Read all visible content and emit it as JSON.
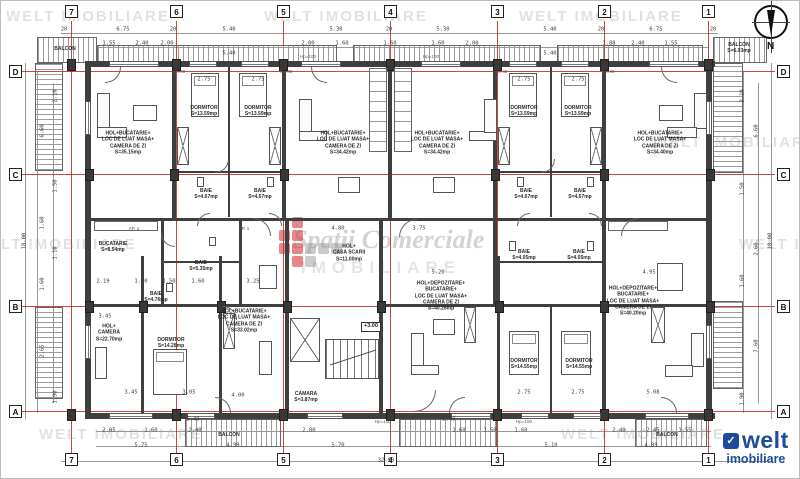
{
  "watermark": {
    "text": "WELT IMOBILIARE",
    "positions": [
      [
        5,
        8
      ],
      [
        263,
        8
      ],
      [
        518,
        8
      ],
      [
        652,
        134
      ],
      [
        -28,
        236
      ],
      [
        738,
        236
      ],
      [
        38,
        426
      ],
      [
        560,
        426
      ]
    ],
    "center_title": "Spații Comerciale",
    "center_sub": "IMOBILIARE"
  },
  "brand": {
    "name": "welt",
    "sub": "imobiliare",
    "icon": "✓"
  },
  "compass": {
    "label": "N"
  },
  "level_marker": "+3.00",
  "grid": {
    "cols": [
      {
        "label": "7",
        "x": 70
      },
      {
        "label": "6",
        "x": 175
      },
      {
        "label": "5",
        "x": 282
      },
      {
        "label": "4",
        "x": 389
      },
      {
        "label": "3",
        "x": 496
      },
      {
        "label": "2",
        "x": 603
      },
      {
        "label": "1",
        "x": 707
      }
    ],
    "rows": [
      {
        "label": "D",
        "y": 70
      },
      {
        "label": "C",
        "y": 173
      },
      {
        "label": "B",
        "y": 305
      },
      {
        "label": "A",
        "y": 410
      }
    ]
  },
  "rooms": [
    {
      "label": "HOL+BUCATARIE+\nLOC DE LUAT MASA+\nCAMERA DE ZI\nS=35.15mp",
      "x": 127,
      "y": 142
    },
    {
      "label": "DORMITOR\nS=13.59mp",
      "x": 203,
      "y": 110
    },
    {
      "label": "DORMITOR\nS=13.59mp",
      "x": 257,
      "y": 110
    },
    {
      "label": "BAIE\nS=4.67mp",
      "x": 205,
      "y": 193
    },
    {
      "label": "BAIE\nS=4.67mp",
      "x": 259,
      "y": 193
    },
    {
      "label": "HOL+BUCATARIE+\nLOC DE LUAT MASA+\nCAMERA DE ZI\nS=34.42mp",
      "x": 342,
      "y": 142
    },
    {
      "label": "HOL+BUCATARIE+\nLOC DE LUAT MASA+\nCAMERA DE ZI\nS=34.42mp",
      "x": 436,
      "y": 142
    },
    {
      "label": "DORMITOR\nS=13.59mp",
      "x": 523,
      "y": 110
    },
    {
      "label": "DORMITOR\nS=13.59mp",
      "x": 577,
      "y": 110
    },
    {
      "label": "BAIE\nS=4.67mp",
      "x": 525,
      "y": 193
    },
    {
      "label": "BAIE\nS=4.67mp",
      "x": 579,
      "y": 193
    },
    {
      "label": "HOL+BUCATARIE+\nLOC DE LUAT MASA+\nCAMERA DE ZI\nS=34.40mp",
      "x": 659,
      "y": 142
    },
    {
      "label": "BUCATARIE\nS=8.54mp",
      "x": 112,
      "y": 246
    },
    {
      "label": "BAIE\nS=5.35mp",
      "x": 200,
      "y": 265
    },
    {
      "label": "BAIE\nS=4.76mp",
      "x": 155,
      "y": 296
    },
    {
      "label": "HOL+\nCASA SCARII\nS=11.00mp",
      "x": 348,
      "y": 252
    },
    {
      "label": "HOL+BUCATARIE+\nLOC DE LUAT MASA+\nCAMERA DE ZI\nS=33.02mp",
      "x": 243,
      "y": 320
    },
    {
      "label": "HOL+\nCAMERA\nS=22.70mp",
      "x": 108,
      "y": 332
    },
    {
      "label": "DORMITOR\nS=14.28mp",
      "x": 170,
      "y": 342
    },
    {
      "label": "CAMARA\nS=3.87mp",
      "x": 305,
      "y": 396
    },
    {
      "label": "HOL+DEPOZITARE+\nBUCATARIE+\nLOC DE LUAT MASA+\nCAMERA DE ZI\nS=40.26mp",
      "x": 440,
      "y": 295
    },
    {
      "label": "DORMITOR\nS=14.55mp",
      "x": 523,
      "y": 363
    },
    {
      "label": "DORMITOR\nS=14.55mp",
      "x": 578,
      "y": 363
    },
    {
      "label": "BAIE\nS=4.05mp",
      "x": 523,
      "y": 254
    },
    {
      "label": "BAIE\nS=4.05mp",
      "x": 578,
      "y": 254
    },
    {
      "label": "HOL+DEPOZITARE+\nBUCATARIE+\nLOC DE LUAT MASA+\nCAMERA DE ZI\nS=40.20mp",
      "x": 632,
      "y": 300
    },
    {
      "label": "BALCON",
      "x": 64,
      "y": 48
    },
    {
      "label": "BALCON\nS=6.03mp",
      "x": 738,
      "y": 47
    },
    {
      "label": "BALCON",
      "x": 228,
      "y": 434
    },
    {
      "label": "BALCON",
      "x": 666,
      "y": 434
    }
  ],
  "dims": [
    {
      "t": "20",
      "x": 63,
      "y": 29
    },
    {
      "t": "6.75",
      "x": 122,
      "y": 29
    },
    {
      "t": "20",
      "x": 172,
      "y": 29
    },
    {
      "t": "5.40",
      "x": 228,
      "y": 29
    },
    {
      "t": "5.30",
      "x": 335,
      "y": 29
    },
    {
      "t": "20",
      "x": 388,
      "y": 29
    },
    {
      "t": "5.30",
      "x": 442,
      "y": 29
    },
    {
      "t": "5.40",
      "x": 549,
      "y": 29
    },
    {
      "t": "20",
      "x": 600,
      "y": 29
    },
    {
      "t": "6.75",
      "x": 655,
      "y": 29
    },
    {
      "t": "20",
      "x": 712,
      "y": 29
    },
    {
      "t": "1.55",
      "x": 108,
      "y": 43
    },
    {
      "t": "2.40",
      "x": 141,
      "y": 43
    },
    {
      "t": "2.00",
      "x": 166,
      "y": 43
    },
    {
      "t": "2.00",
      "x": 307,
      "y": 43
    },
    {
      "t": "1.60",
      "x": 341,
      "y": 43
    },
    {
      "t": "1.60",
      "x": 389,
      "y": 43
    },
    {
      "t": "1.60",
      "x": 437,
      "y": 43
    },
    {
      "t": "2.00",
      "x": 471,
      "y": 43
    },
    {
      "t": "1.88",
      "x": 608,
      "y": 43
    },
    {
      "t": "2.40",
      "x": 637,
      "y": 43
    },
    {
      "t": "1.55",
      "x": 670,
      "y": 43
    },
    {
      "t": "5.40",
      "x": 228,
      "y": 53
    },
    {
      "t": "5.40",
      "x": 549,
      "y": 53
    },
    {
      "t": "2.75",
      "x": 203,
      "y": 79
    },
    {
      "t": "2.75",
      "x": 257,
      "y": 79
    },
    {
      "t": "2.75",
      "x": 523,
      "y": 79
    },
    {
      "t": "2.75",
      "x": 577,
      "y": 79
    },
    {
      "t": "4.80",
      "x": 337,
      "y": 228
    },
    {
      "t": "3.75",
      "x": 418,
      "y": 228
    },
    {
      "t": "2.19",
      "x": 102,
      "y": 281
    },
    {
      "t": "1.10",
      "x": 140,
      "y": 281
    },
    {
      "t": "1.50",
      "x": 168,
      "y": 281
    },
    {
      "t": "1.60",
      "x": 197,
      "y": 281
    },
    {
      "t": "3.25",
      "x": 252,
      "y": 281
    },
    {
      "t": "5.20",
      "x": 437,
      "y": 272
    },
    {
      "t": "4.95",
      "x": 648,
      "y": 272
    },
    {
      "t": "3.45",
      "x": 104,
      "y": 316
    },
    {
      "t": "3.45",
      "x": 130,
      "y": 392
    },
    {
      "t": "3.05",
      "x": 188,
      "y": 392
    },
    {
      "t": "4.00",
      "x": 237,
      "y": 395
    },
    {
      "t": "2.75",
      "x": 523,
      "y": 392
    },
    {
      "t": "2.75",
      "x": 577,
      "y": 392
    },
    {
      "t": "5.08",
      "x": 652,
      "y": 392
    },
    {
      "t": "5.40",
      "x": 192,
      "y": 419
    },
    {
      "t": "5.40",
      "x": 448,
      "y": 419
    },
    {
      "t": "2.05",
      "x": 108,
      "y": 430
    },
    {
      "t": "1.60",
      "x": 150,
      "y": 430
    },
    {
      "t": "2.40",
      "x": 194,
      "y": 430
    },
    {
      "t": "2.80",
      "x": 308,
      "y": 430
    },
    {
      "t": "1.60",
      "x": 458,
      "y": 430
    },
    {
      "t": "1.50",
      "x": 489,
      "y": 430
    },
    {
      "t": "1.60",
      "x": 520,
      "y": 430
    },
    {
      "t": "2.40",
      "x": 618,
      "y": 430
    },
    {
      "t": "2.45",
      "x": 652,
      "y": 430
    },
    {
      "t": "1.55",
      "x": 684,
      "y": 430
    },
    {
      "t": "5.75",
      "x": 140,
      "y": 445
    },
    {
      "t": "4.99",
      "x": 232,
      "y": 445
    },
    {
      "t": "5.70",
      "x": 337,
      "y": 445
    },
    {
      "t": "5.10",
      "x": 550,
      "y": 445
    },
    {
      "t": "4.99",
      "x": 650,
      "y": 445
    },
    {
      "t": "32.90",
      "x": 385,
      "y": 460
    },
    {
      "t": "2.10",
      "x": 55,
      "y": 95,
      "r": 1
    },
    {
      "t": "6.60",
      "x": 42,
      "y": 130,
      "r": 1
    },
    {
      "t": "1.50",
      "x": 55,
      "y": 185,
      "r": 1
    },
    {
      "t": "1.60",
      "x": 42,
      "y": 222,
      "r": 1
    },
    {
      "t": "1.10",
      "x": 55,
      "y": 252,
      "r": 1
    },
    {
      "t": "1.60",
      "x": 42,
      "y": 283,
      "r": 1
    },
    {
      "t": "2.65",
      "x": 42,
      "y": 350,
      "r": 1
    },
    {
      "t": "1.90",
      "x": 55,
      "y": 396,
      "r": 1
    },
    {
      "t": "18.00",
      "x": 24,
      "y": 240,
      "r": 1
    },
    {
      "t": "2.10",
      "x": 742,
      "y": 95,
      "r": 1
    },
    {
      "t": "6.60",
      "x": 756,
      "y": 130,
      "r": 1
    },
    {
      "t": "1.50",
      "x": 742,
      "y": 188,
      "r": 1
    },
    {
      "t": "2.60",
      "x": 756,
      "y": 248,
      "r": 1
    },
    {
      "t": "1.60",
      "x": 742,
      "y": 280,
      "r": 1
    },
    {
      "t": "7.60",
      "x": 756,
      "y": 345,
      "r": 1
    },
    {
      "t": "1.90",
      "x": 742,
      "y": 398,
      "r": 1
    },
    {
      "t": "18.00",
      "x": 770,
      "y": 240,
      "r": 1
    }
  ],
  "notes": [
    {
      "t": "hp=40",
      "x": 178,
      "y": 71
    },
    {
      "t": "hp=40",
      "x": 285,
      "y": 71
    },
    {
      "t": "hp=40",
      "x": 500,
      "y": 71
    },
    {
      "t": "hp=40",
      "x": 607,
      "y": 71
    },
    {
      "t": "Hp=100",
      "x": 307,
      "y": 56
    },
    {
      "t": "Hp=100",
      "x": 430,
      "y": 56
    },
    {
      "t": "Hp=100",
      "x": 382,
      "y": 421
    },
    {
      "t": "Hp=100",
      "x": 523,
      "y": 421
    },
    {
      "t": "AP. 2",
      "x": 133,
      "y": 228
    },
    {
      "t": "AP. 1",
      "x": 243,
      "y": 228
    }
  ]
}
